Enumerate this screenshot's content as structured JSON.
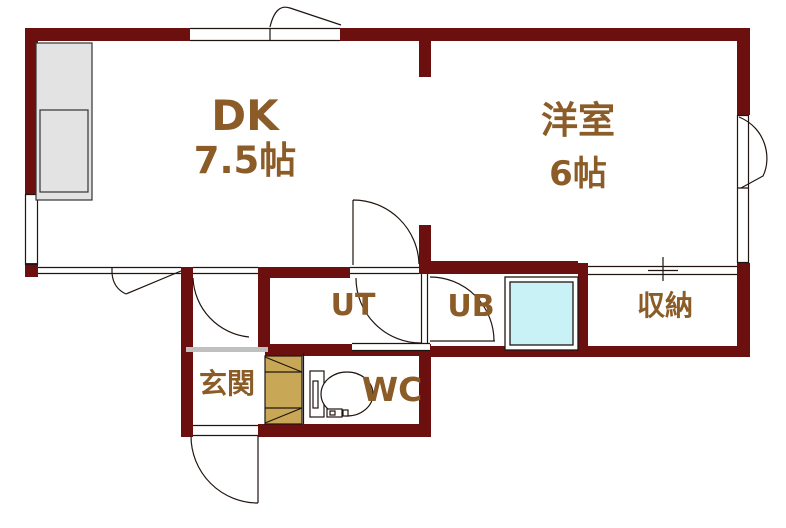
{
  "plan_title": "1DK apartment floor plan",
  "rooms": [
    {
      "name": "dining-kitchen",
      "label": "DK",
      "size_label": "7.5帖"
    },
    {
      "name": "western-room",
      "label": "洋室",
      "size_label": "6帖"
    },
    {
      "name": "utility",
      "label": "UT"
    },
    {
      "name": "unit-bath",
      "label": "UB"
    },
    {
      "name": "storage",
      "label": "収納"
    },
    {
      "name": "entrance",
      "label": "玄関"
    },
    {
      "name": "toilet-room",
      "label": "WC"
    }
  ],
  "fixtures": [
    "kitchen-counter",
    "bathtub",
    "toilet",
    "shoe-cabinet",
    "entrance-step"
  ],
  "colors": {
    "wall": "#6b0f0f",
    "label_text": "#8b5c28",
    "bathtub_fill": "#c9f2f7",
    "shoe_cabinet_fill": "#c8a857",
    "kitchen_fill": "#e3e3e3",
    "entrance_step": "#c0c0c0",
    "line": "#201510",
    "background": "#ffffff"
  }
}
